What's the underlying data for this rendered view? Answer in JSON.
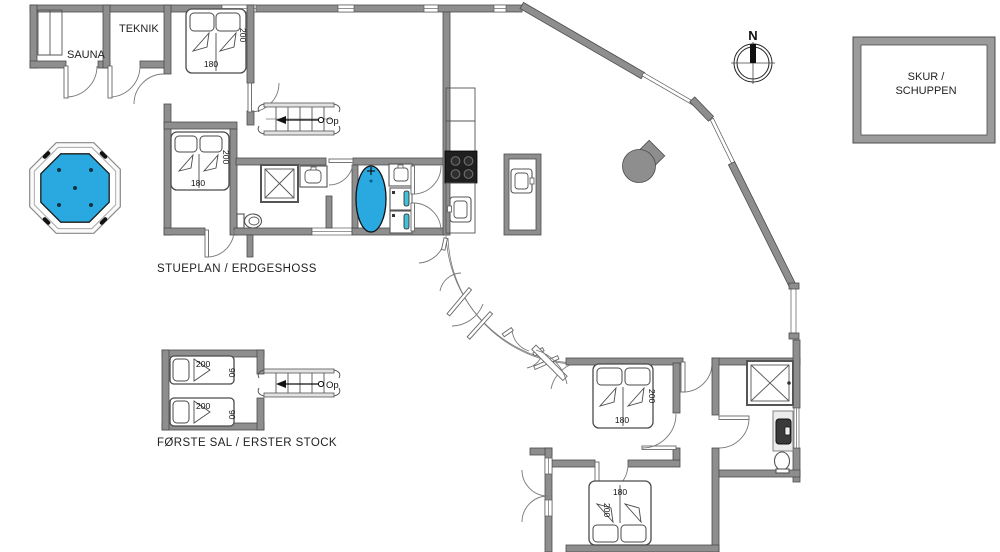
{
  "titles": {
    "ground": "STUEPLAN / ERDGESHOSS",
    "first": "FØRSTE SAL / ERSTER STOCK"
  },
  "rooms": {
    "sauna": "SAUNA",
    "teknik": "TEKNIK",
    "shed_line1": "SKUR /",
    "shed_line2": "SCHUPPEN"
  },
  "compass": {
    "north": "N"
  },
  "stairs": {
    "up_label": "Op"
  },
  "bed_dimensions": {
    "double_width": "180",
    "double_length": "200",
    "single_width": "90",
    "single_length": "200"
  },
  "colors": {
    "wall": "#8e8e8e",
    "water_blue": "#29a9df",
    "appliance_teal": "#45c0d6",
    "stove_black": "#1f1f1f",
    "background": "#ffffff"
  }
}
